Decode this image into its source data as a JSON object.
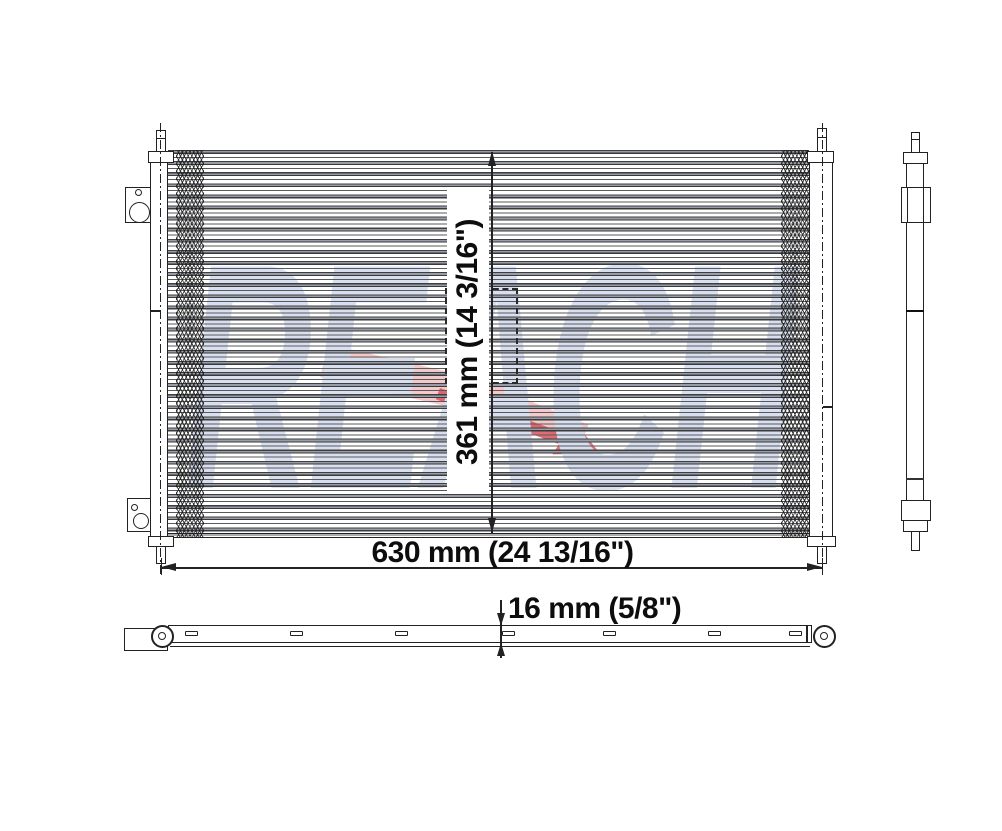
{
  "watermark": {
    "text": "REACH"
  },
  "dimensions": {
    "height": "361 mm (14 3/16\")",
    "width": "630 mm (24 13/16\")",
    "depth": "16 mm (5/8\")"
  },
  "colors": {
    "background": "#ffffff",
    "line": "#222222",
    "watermark_letters": "#d8dff0",
    "watermark_swoosh_light": "#f4c9cb",
    "watermark_swoosh_dark": "#d9545a"
  }
}
